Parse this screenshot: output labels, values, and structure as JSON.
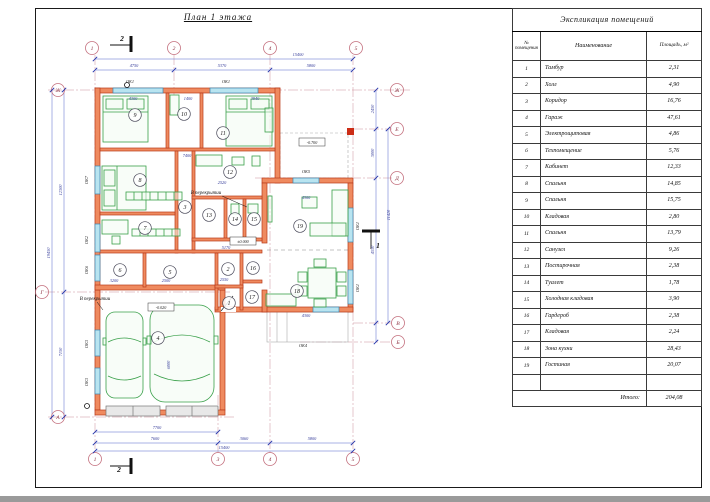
{
  "drawing": {
    "title": "План 1 этажа",
    "axes": {
      "top": [
        "1",
        "2",
        "4",
        "5"
      ],
      "bottom": [
        "1",
        "3",
        "4",
        "5"
      ],
      "left": [
        "Ж",
        "Г",
        "А"
      ],
      "right": [
        "Ж",
        "Е",
        "Д",
        "В",
        "Б"
      ]
    },
    "rooms": [
      "1",
      "2",
      "3",
      "4",
      "5",
      "6",
      "7",
      "8",
      "9",
      "10",
      "11",
      "12",
      "13",
      "14",
      "15",
      "16",
      "17",
      "18",
      "19"
    ],
    "window_tags": [
      "ОК1",
      "ОК1",
      "ОК5",
      "ОК7",
      "ОК2",
      "ОК6",
      "ОК3",
      "ОК3",
      "ОК1",
      "ОК1",
      "ОК4"
    ],
    "dimensions": [
      "15400",
      "4750",
      "5370",
      "5800",
      "7700",
      "7600",
      "3060",
      "5800",
      "15400",
      "12300",
      "7150",
      "19450",
      "2450",
      "3000",
      "11420",
      "4550",
      "4300",
      "1400",
      "3940",
      "7400",
      "2520",
      "5170",
      "3200",
      "2500",
      "2550",
      "4300",
      "4300",
      "6000"
    ],
    "levels": [
      "-0.700",
      "±0.000",
      "-0.020"
    ],
    "section_marks": [
      "2",
      "2",
      "1"
    ],
    "notes": [
      "В перекрытии",
      "В перекрытии"
    ]
  },
  "table": {
    "title": "Экспликация помещений",
    "columns": {
      "number": "№ помещения",
      "name": "Наименование",
      "area": "Площадь, м²"
    },
    "rows": [
      [
        "1",
        "Тамбур",
        "2,31"
      ],
      [
        "2",
        "Холл",
        "4,90"
      ],
      [
        "3",
        "Коридор",
        "16,76"
      ],
      [
        "4",
        "Гараж",
        "47,61"
      ],
      [
        "5",
        "Электрощитовая",
        "4,86"
      ],
      [
        "6",
        "Техпомещение",
        "5,76"
      ],
      [
        "7",
        "Кабинет",
        "12,33"
      ],
      [
        "8",
        "Спальня",
        "14,85"
      ],
      [
        "9",
        "Спальня",
        "15,75"
      ],
      [
        "10",
        "Кладовая",
        "2,80"
      ],
      [
        "11",
        "Спальня",
        "13,79"
      ],
      [
        "12",
        "Санузел",
        "9,26"
      ],
      [
        "13",
        "Постирочная",
        "2,38"
      ],
      [
        "14",
        "Туалет",
        "1,78"
      ],
      [
        "15",
        "Холодная кладовая",
        "3,90"
      ],
      [
        "16",
        "Гардероб",
        "2,38"
      ],
      [
        "17",
        "Кладовая",
        "2,24"
      ],
      [
        "18",
        "Зона кухни",
        "28,43"
      ],
      [
        "19",
        "Гостиная",
        "20,07"
      ]
    ],
    "total_label": "Итого:",
    "total_value": "204,08"
  }
}
